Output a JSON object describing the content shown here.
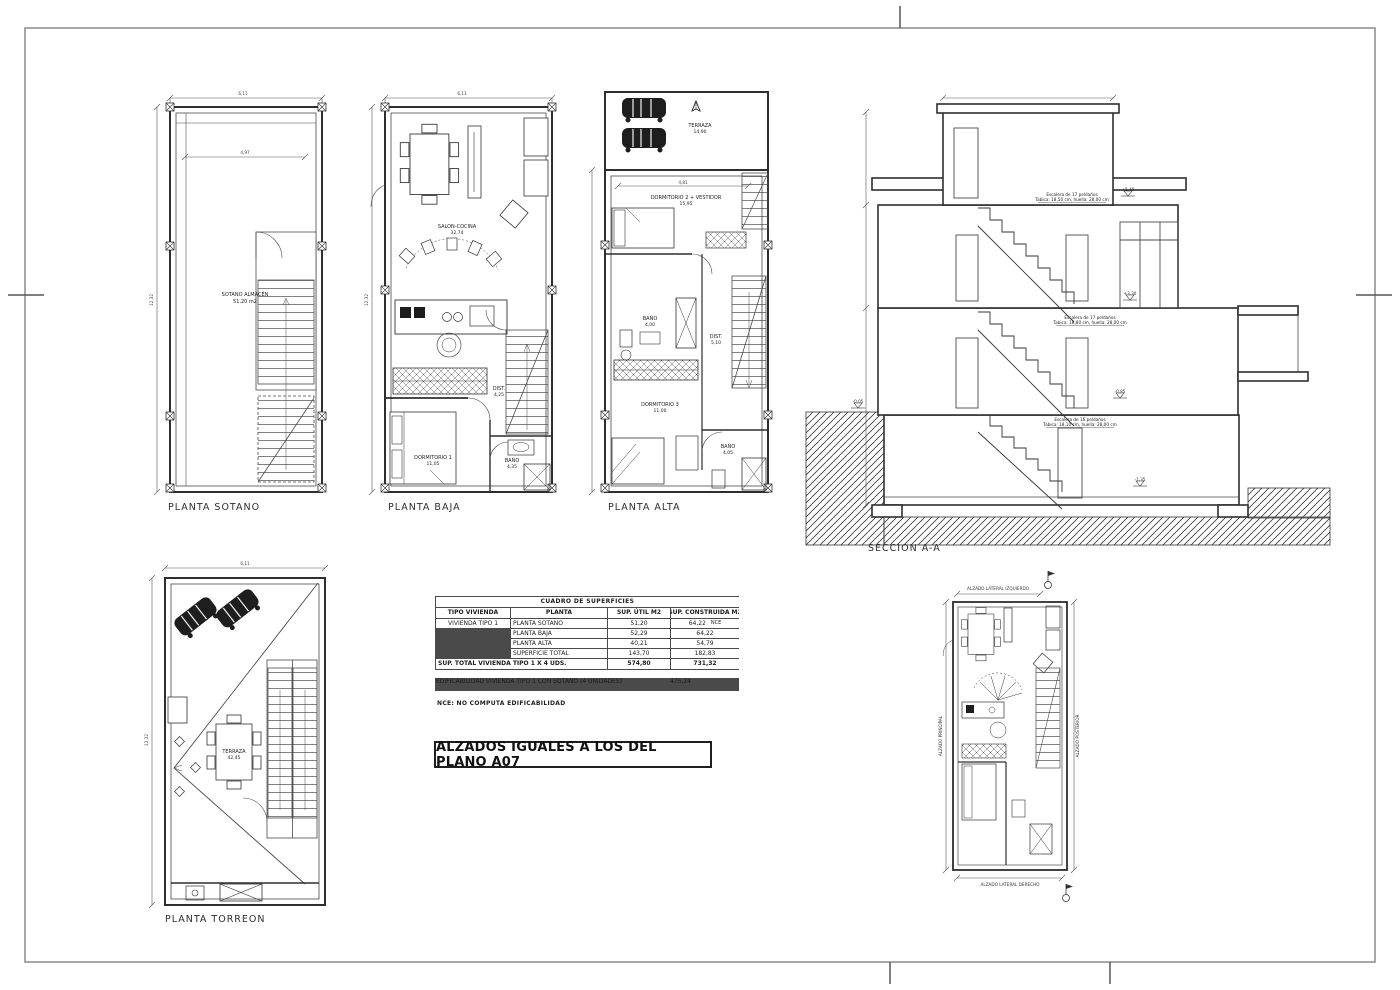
{
  "captions": {
    "sotano": "PLANTA SOTANO",
    "baja": "PLANTA BAJA",
    "alta": "PLANTA ALTA",
    "seccion": "SECCION A-A",
    "torreon": "PLANTA TORREON"
  },
  "sotano": {
    "dim_width": "6,11",
    "dim_inner": "4,97",
    "dim_height": "12,32",
    "room_name": "SOTANO ALMACÉN",
    "room_area": "51,20 m2"
  },
  "baja": {
    "dim_width": "6,11",
    "dim_height": "12,32",
    "salon_name": "SALON-COCINA",
    "salon_area": "32,74",
    "dist_name": "DIST.",
    "dist_area": "4,25",
    "dorm_name": "DORMITORIO 1",
    "dorm_area": "11,05",
    "bano_name": "BAÑO",
    "bano_area": "4,35"
  },
  "alta": {
    "terraza_name": "TERRAZA",
    "terraza_area": "14,90",
    "dim_inner": "4,81",
    "dorm2_name": "DORMITORIO 2 + VESTIDOR",
    "dorm2_area": "15,95",
    "bano1_name": "BAÑO",
    "bano1_area": "4,00",
    "dist_name": "DIST.",
    "dist_area": "5,10",
    "dorm3_name": "DORMITORIO 3",
    "dorm3_area": "11,00",
    "bano2_name": "BAÑO",
    "bano2_area": "4,05"
  },
  "torreon": {
    "dim_width": "6,11",
    "dim_height": "12,32",
    "terraza_name": "TERRAZA",
    "terraza_area": "42,45"
  },
  "section": {
    "stairs": [
      {
        "line1": "Escalera de 17 peldaños",
        "line2": "Tabica: 18,50 cm, huella: 28,00 cm"
      },
      {
        "line1": "Escalera de 17 peldaños",
        "line2": "Tabica: 18,80 cm, huella: 28,00 cm"
      },
      {
        "line1": "Escalera de 16 peldaños",
        "line2": "Tabica: 18,10 cm, huella: 28,00 cm"
      }
    ],
    "levels": {
      "top": "+5,40",
      "mid": "+3,30",
      "low": "-0,85",
      "street": "-0,05",
      "basement": "-1,35"
    }
  },
  "surfaces_table": {
    "title": "CUADRO DE SUPERFICIES",
    "col_tipo": "TIPO VIVIENDA",
    "col_planta": "PLANTA",
    "col_util": "SUP. ÚTIL M2",
    "col_cons": "SUP. CONSTRUIDA M2",
    "tipo": "VIVIENDA TIPO 1",
    "rows": [
      {
        "planta": "PLANTA SOTANO",
        "util": "51,20",
        "cons": "64,22",
        "tag": "NCE"
      },
      {
        "planta": "PLANTA BAJA",
        "util": "52,29",
        "cons": "64,22",
        "tag": ""
      },
      {
        "planta": "PLANTA ALTA",
        "util": "40,21",
        "cons": "54,79",
        "tag": ""
      },
      {
        "planta": "SUPERFICIE TOTAL",
        "util": "143,70",
        "cons": "182,83",
        "tag": ""
      }
    ],
    "total_label": "SUP. TOTAL VIVIENDA TIPO 1 X 4 UDS.",
    "total_util": "574,80",
    "total_cons": "731,32",
    "edif_label": "EDIFICABILIDAD VIVIENDA TIPO 1 CON SOTANO (4 UNIDADES)",
    "edif_value": "475,24",
    "note": "NCE:  NO COMPUTA EDIFICABILIDAD"
  },
  "alzados_note": "ALZADOS IGUALES A LOS DEL PLANO A07",
  "keyplan": {
    "top": "ALZADO LATERAL IZQUIERDO",
    "bottom": "ALZADO LATERAL DERECHO",
    "left": "ALZADO PRINCIPAL",
    "right": "ALZADO POSTERIOR"
  },
  "colors": {
    "line": "#2e2e2e",
    "paper": "#ffffff",
    "frame": "#8b8b8b"
  }
}
